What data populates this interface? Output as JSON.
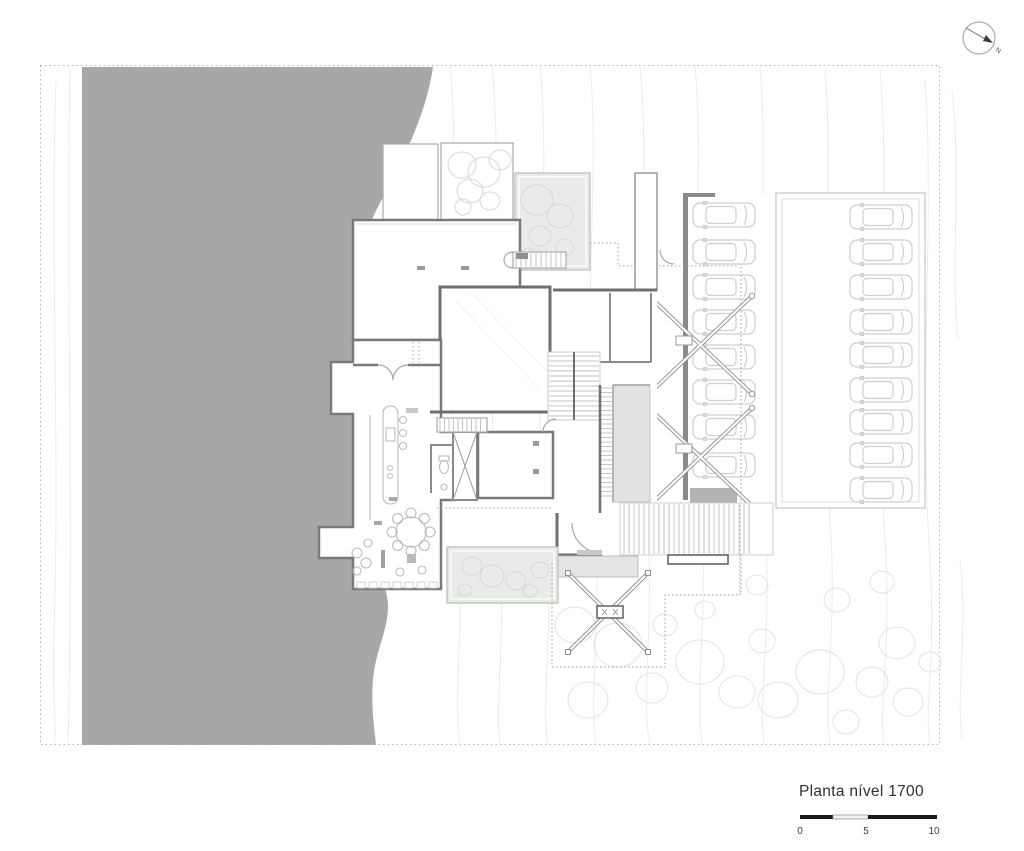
{
  "drawing": {
    "title": "Planta nível 1700",
    "compass_label": "N",
    "scale_bar": {
      "labels": [
        "0",
        "5",
        "10"
      ]
    },
    "parking": {
      "left_column_cars": 8,
      "right_column_cars": 9,
      "total_cars": 17
    },
    "colors": {
      "terrain_gray": "#a7a7a7",
      "wall_dark": "#6f6f6f",
      "wall_medium": "#8a8a8a",
      "roof_garden_fill": "#e9ebe8",
      "ramp_fill": "#e2e2e2",
      "accent_fill": "#b3b3b3",
      "contour_line": "#ebebeb",
      "car_outline": "#ccd0cc",
      "text": "#303030"
    }
  }
}
